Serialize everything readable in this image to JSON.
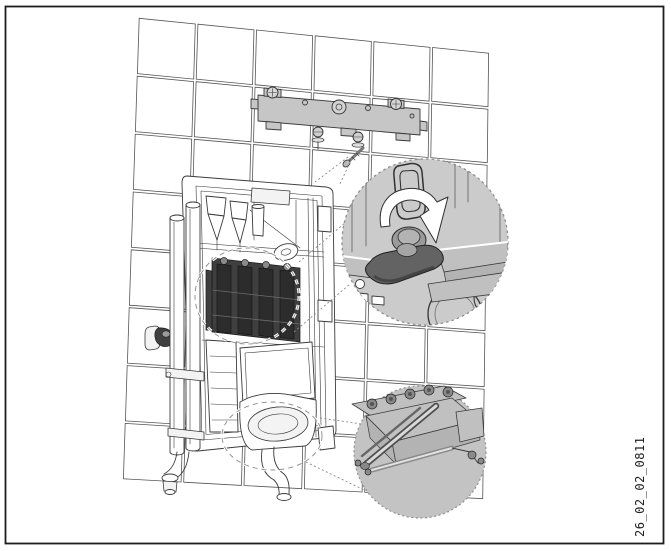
{
  "figure": {
    "label": "26_02_02_0811"
  },
  "icons": {
    "rotation_arrow": "curved-arrow-clockwise"
  },
  "colors": {
    "ink": "#3a3a3a",
    "grid_line": "#555555",
    "frame_border": "#1c1c1c",
    "bracket_fill": "#c6c6c6",
    "callout_upper_fill": "#cbcbcb",
    "callout_lower_fill": "#c3c3c3",
    "knob_dark": "#636363",
    "dark_block": "#3f3f3f",
    "arrow_white": "#ffffff",
    "label_text": "#222222"
  }
}
